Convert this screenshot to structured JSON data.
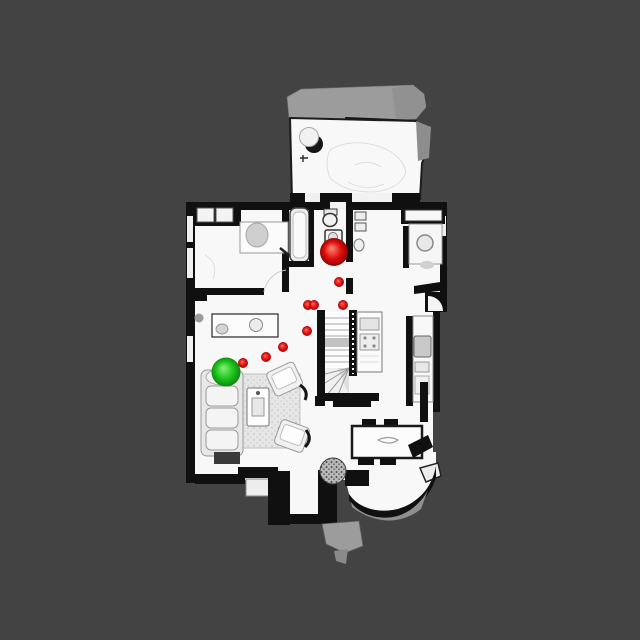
{
  "scene": {
    "description": "top-down rendered mesh of a two-story house interior used as a navigation map",
    "background_color": "#434343",
    "floor_color": "#f8f8f8",
    "wall_color": "#101010",
    "roof_color": "#9c9c9c"
  },
  "overlay": {
    "start_marker": {
      "x": 226,
      "y": 372,
      "radius": 14.5,
      "color": "#1ec41e",
      "highlight": "#8bf07f",
      "edge": "#0a7d0a"
    },
    "goal_marker": {
      "x": 334,
      "y": 252,
      "radius": 14,
      "color": "#e00e0e",
      "highlight": "#ff8d7a",
      "edge": "#7d0202"
    },
    "waypoint": {
      "radius": 5,
      "color": "#e01414",
      "highlight": "#ff6b5e",
      "edge": "#8f0505"
    },
    "waypoints": [
      {
        "x": 339,
        "y": 282
      },
      {
        "x": 308,
        "y": 305
      },
      {
        "x": 314,
        "y": 305
      },
      {
        "x": 343,
        "y": 305
      },
      {
        "x": 307,
        "y": 331
      },
      {
        "x": 283,
        "y": 347
      },
      {
        "x": 266,
        "y": 357
      },
      {
        "x": 243,
        "y": 363
      }
    ]
  }
}
